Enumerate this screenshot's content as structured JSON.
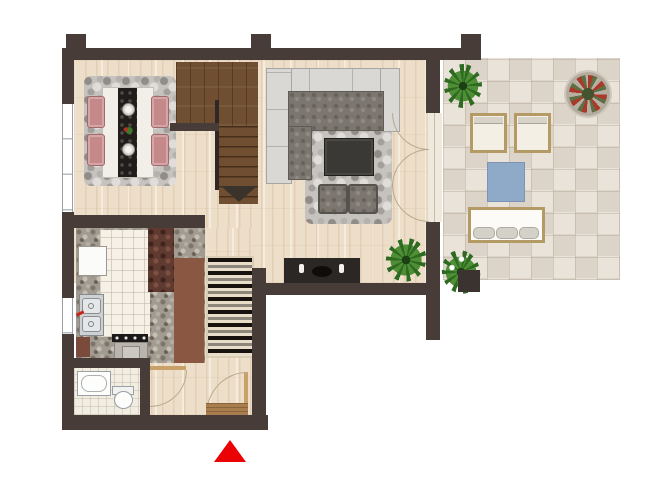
{
  "document": {
    "type": "residential floor plan, top-down render",
    "visible_text": [],
    "rooms": [
      {
        "name": "dining-area"
      },
      {
        "name": "living-room"
      },
      {
        "name": "kitchen"
      },
      {
        "name": "corridor"
      },
      {
        "name": "entry-hall"
      },
      {
        "name": "bathroom"
      },
      {
        "name": "staircase"
      },
      {
        "name": "terrace"
      }
    ],
    "objects": {
      "dining_area": [
        "pebble-rug",
        "dining-table",
        "dark-table-runner",
        "two-plates",
        "flower-centerpiece",
        "four-rose-chairs"
      ],
      "living_room": [
        "l-shaped-sectional-sofa",
        "pebble-rug",
        "dark-coffee-table",
        "two-ottomans",
        "dark-sideboard-with-candles",
        "potted-plant"
      ],
      "kitchen": [
        "terrazzo-counters",
        "white-tile-floor",
        "refrigerator",
        "double-sink-with-faucet",
        "cooktop-and-oven",
        "two-wood-cabinets"
      ],
      "corridor": [
        "wave-pattern-runner-rug"
      ],
      "entry_hall": [
        "entry-door-with-swing-arc",
        "doormat"
      ],
      "bathroom": [
        "bathtub",
        "toilet",
        "door-with-swing-arc"
      ],
      "staircase": [
        "upper-landing",
        "descending-flight",
        "direction-arrow"
      ],
      "terrace": [
        "stone-paving",
        "palm-plant",
        "round-stone-planter-with-red-flowers",
        "two-sun-loungers",
        "blue-square-mat",
        "outdoor-bench-with-three-cushions",
        "flowering-plant-in-square-pot"
      ],
      "openings": [
        "triple-french-door-to-terrace",
        "tall-window-left-dining",
        "kitchen-window-left"
      ]
    },
    "markers": {
      "entrance_arrow": {
        "shape": "triangle-up",
        "color": "#ea0204"
      }
    }
  },
  "palette": {
    "wall": "#483c39",
    "wood_floor": "#eddec9",
    "stair_wood": "#6f4e31",
    "terrace_stone": "#e9e3d9",
    "rug_pebble_gray": "#c6c2be",
    "chair_rose": "#c5898a",
    "sofa_light": "#d9d8d4",
    "cushion_dark": "#7b766f",
    "coffee_table": "#3b3936",
    "blue_mat": "#8fa9c9",
    "outdoor_wood": "#b49b66",
    "plant_green": "#2e6a22",
    "counter_terrazzo": "#a29b91",
    "cabinet_brown": "#8a5742",
    "kitchen_tile": "#f6f1e7",
    "entrance_red": "#ea0204"
  }
}
